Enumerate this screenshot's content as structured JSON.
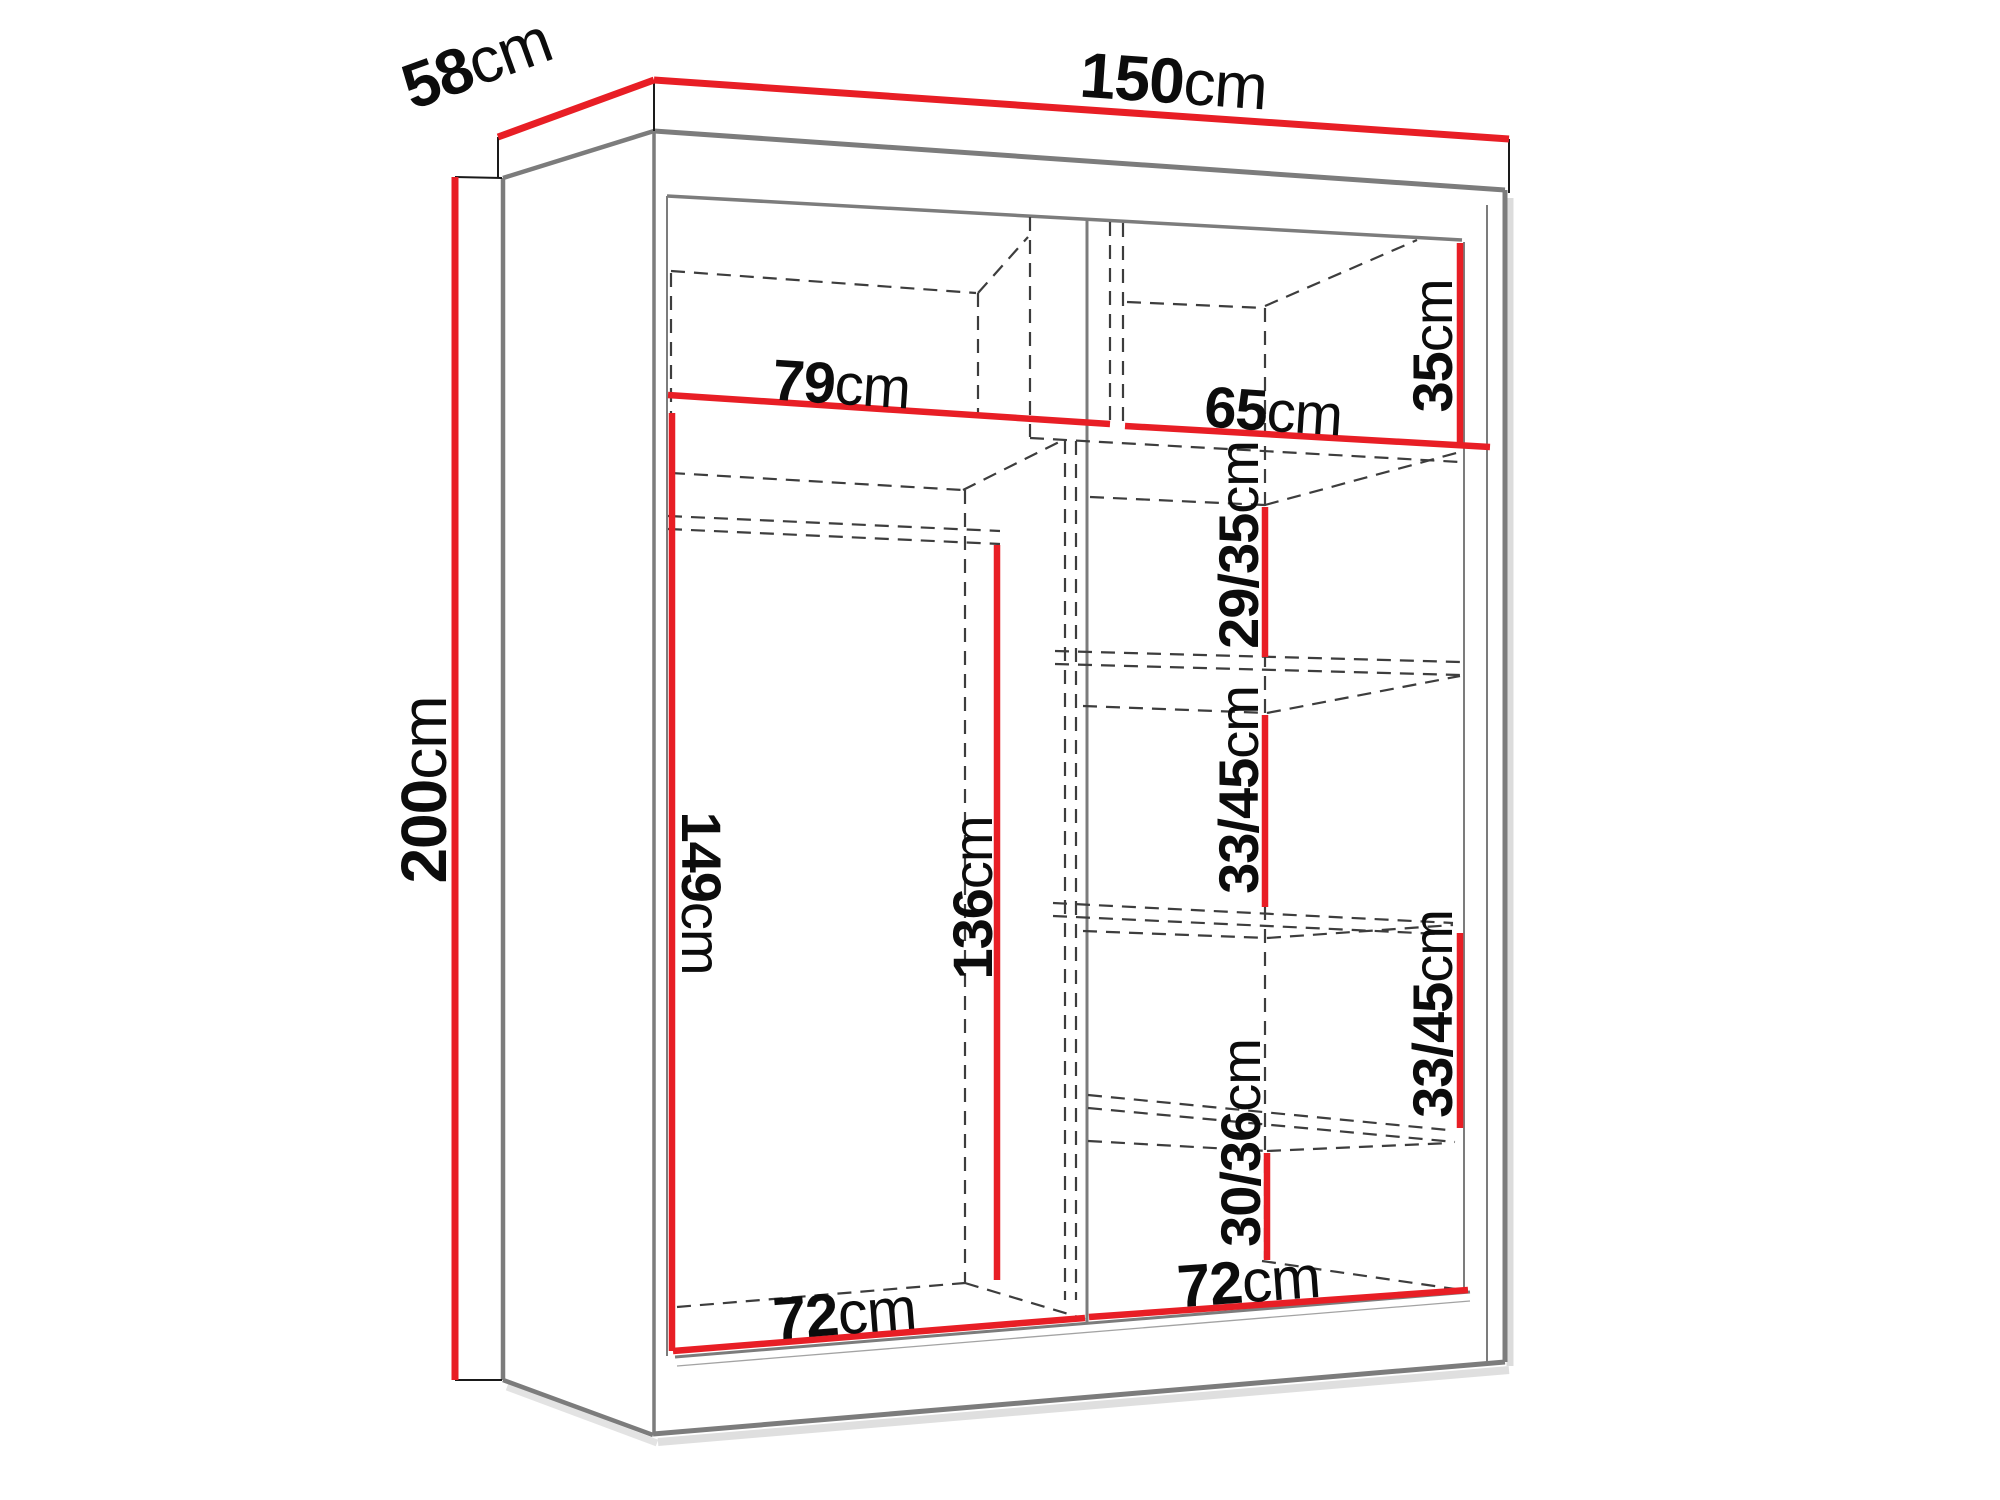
{
  "diagram": {
    "type": "furniture-dimension-diagram",
    "subject": "two-door sliding wardrobe with shelves and hanging rail",
    "unit": "cm",
    "colors": {
      "dimension_line": "#e81e25",
      "edge": "#7c7c7c",
      "hidden_line": "#3d3d3d",
      "tick": "#1a1a1a",
      "label_text": "#0c0c0c",
      "shadow": "#c0c0c0",
      "background": "#ffffff"
    },
    "labels": {
      "width": {
        "num": "150",
        "unit": "cm"
      },
      "depth": {
        "num": "58",
        "unit": "cm"
      },
      "height": {
        "num": "200",
        "unit": "cm"
      },
      "top_left_width": {
        "num": "79",
        "unit": "cm"
      },
      "top_right_width": {
        "num": "65",
        "unit": "cm"
      },
      "top_shelf_height": {
        "num": "35",
        "unit": "cm"
      },
      "shelf_gap_upper": {
        "num": "29/35",
        "unit": "cm"
      },
      "shelf_gap_middle": {
        "num": "33/45",
        "unit": "cm"
      },
      "shelf_gap_lower": {
        "num": "33/45",
        "unit": "cm"
      },
      "shelf_gap_bottom": {
        "num": "30/36",
        "unit": "cm"
      },
      "left_inner_height": {
        "num": "149",
        "unit": "cm"
      },
      "hanging_height": {
        "num": "136",
        "unit": "cm"
      },
      "left_inner_width": {
        "num": "72",
        "unit": "cm"
      },
      "right_inner_width": {
        "num": "72",
        "unit": "cm"
      }
    }
  }
}
